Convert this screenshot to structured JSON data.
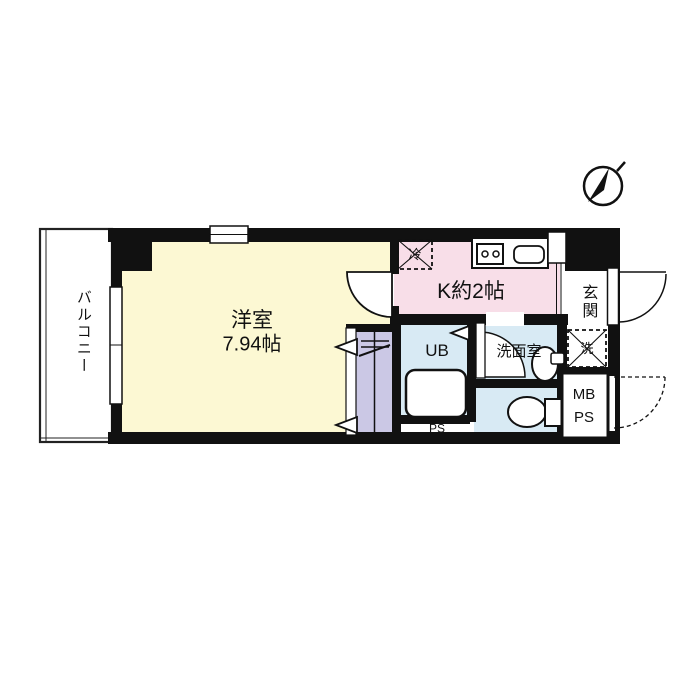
{
  "document_type": "apartment floor plan",
  "colors": {
    "wall": "#111111",
    "living_room_fill": "#fcf8d3",
    "kitchen_fill": "#f8dee8",
    "wet_area_fill": "#d8eaf4",
    "closet_fill": "#cbc8e5",
    "background": "#ffffff",
    "line": "#111111"
  },
  "labels": {
    "balcony": "バルコニー",
    "living_room": "洋室",
    "living_room_size": "7.94帖",
    "kitchen": "K約2帖",
    "unit_bath": "UB",
    "washroom": "洗面室",
    "entrance": "玄関",
    "pipe_space": "PS",
    "meter_box_line1": "MB",
    "meter_box_line2": "PS",
    "refrigerator": "冷",
    "washing_machine": "洗"
  },
  "icons": {
    "compass": "north-arrow-icon",
    "stove": "two-burner-stove-icon",
    "kitchen_sink": "kitchen-sink-icon",
    "bathtub": "bathtub-icon",
    "toilet": "toilet-icon",
    "vanity_sink": "vanity-sink-icon",
    "hanger_pipe": "hanger-pipe-icon",
    "door_swings": "door-swing-arc-icon"
  }
}
